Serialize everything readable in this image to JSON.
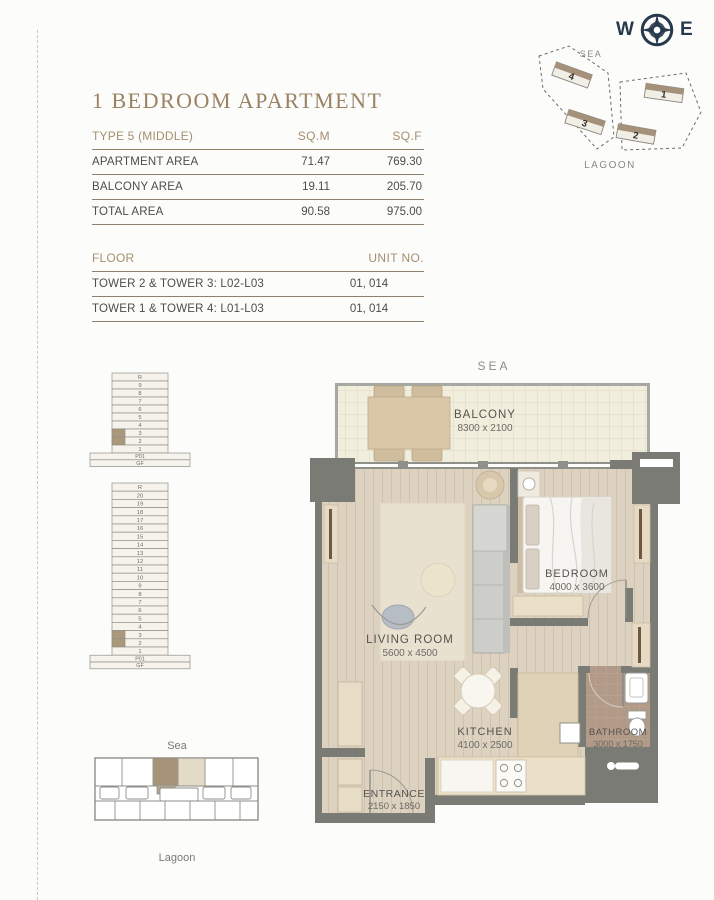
{
  "page": {
    "title": "1 BEDROOM APARTMENT"
  },
  "compass": {
    "west": "W",
    "east": "E"
  },
  "site_plan": {
    "sea": "SEA",
    "lagoon": "LAGOON",
    "towers": [
      {
        "label": "1"
      },
      {
        "label": "2"
      },
      {
        "label": "3"
      },
      {
        "label": "4"
      }
    ]
  },
  "area_table": {
    "header": {
      "type": "TYPE 5 (MIDDLE)",
      "sqm": "SQ.M",
      "sqf": "SQ.F"
    },
    "rows": [
      {
        "label": "APARTMENT AREA",
        "sqm": "71.47",
        "sqf": "769.30"
      },
      {
        "label": "BALCONY AREA",
        "sqm": "19.11",
        "sqf": "205.70"
      },
      {
        "label": "TOTAL AREA",
        "sqm": "90.58",
        "sqf": "975.00"
      }
    ]
  },
  "floor_table": {
    "header": {
      "floor": "FLOOR",
      "unit": "UNIT NO."
    },
    "rows": [
      {
        "floor": "TOWER 2 & TOWER 3: L02-L03",
        "unit": "01, 014"
      },
      {
        "floor": "TOWER 1 & TOWER 4: L01-L03",
        "unit": "01, 014"
      }
    ]
  },
  "stacks": [
    {
      "floors": [
        "R",
        "9",
        "8",
        "7",
        "6",
        "5",
        "4",
        "3",
        "2",
        "1"
      ],
      "base": [
        "P01",
        "GF"
      ],
      "highlighted": [
        "3",
        "2"
      ]
    },
    {
      "floors": [
        "R",
        "20",
        "19",
        "18",
        "17",
        "16",
        "15",
        "14",
        "13",
        "12",
        "11",
        "10",
        "9",
        "8",
        "7",
        "6",
        "5",
        "4",
        "3",
        "2",
        "1"
      ],
      "base": [
        "P01",
        "GF"
      ],
      "highlighted": [
        "3",
        "2"
      ]
    }
  ],
  "key_plan": {
    "sea": "Sea",
    "lagoon": "Lagoon"
  },
  "floor_plan": {
    "sea_label": "SEA",
    "rooms": {
      "balcony": {
        "name": "BALCONY",
        "dims": "8300 x 2100"
      },
      "bedroom": {
        "name": "BEDROOM",
        "dims": "4000 x 3600"
      },
      "living": {
        "name": "LIVING ROOM",
        "dims": "5600 x 4500"
      },
      "kitchen": {
        "name": "KITCHEN",
        "dims": "4100 x 2500"
      },
      "bathroom": {
        "name": "BATHROOM",
        "dims": "3000 x 1750"
      },
      "entrance": {
        "name": "ENTRANCE",
        "dims": "2150 x 1850"
      }
    }
  },
  "colors": {
    "accent_taupe": "#9a8263",
    "table_rule": "#8f7f6b",
    "wall_grey": "#7b7b75",
    "stack_highlight": "#ab9779",
    "wood_floor": "#ddd1c0",
    "bath_floor": "#b19a88",
    "balcony_floor": "#f2eedd",
    "compass_navy": "#27394c"
  }
}
